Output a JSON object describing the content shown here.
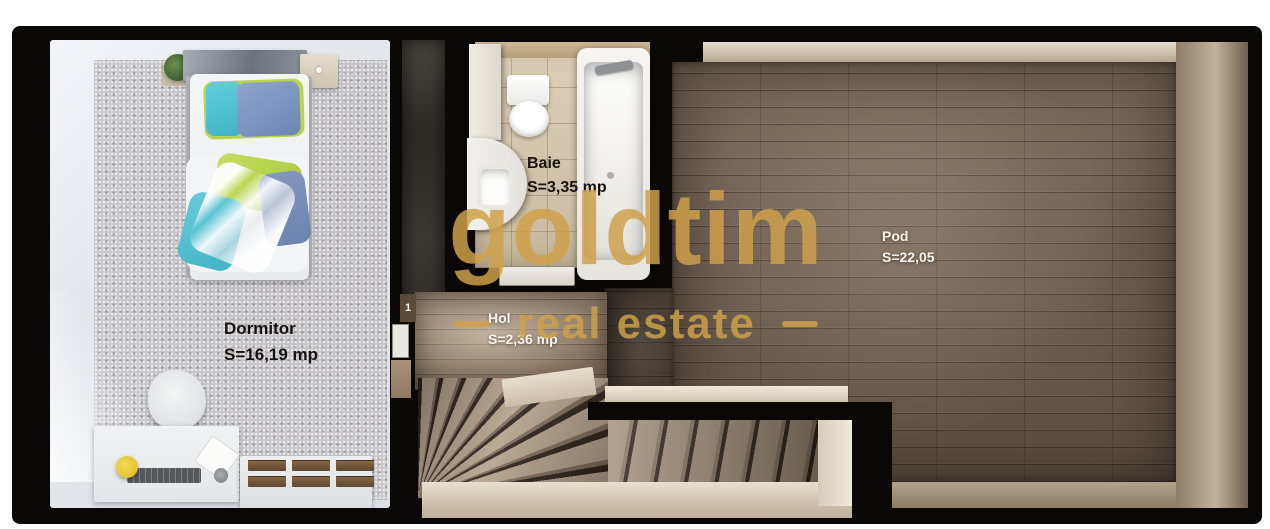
{
  "plan": {
    "door_label": "1",
    "rooms": {
      "dormitor": {
        "name": "Dormitor",
        "area": "S=16,19 mp"
      },
      "baie": {
        "name": "Baie",
        "area": "S=3,35 mp"
      },
      "hol": {
        "name": "Hol",
        "area": "S=2,36 mp"
      },
      "pod": {
        "name": "Pod",
        "area": "S=22,05"
      }
    }
  },
  "watermark": {
    "brand": "goldtim",
    "tagline": "real estate",
    "color": "#cfa14b"
  }
}
